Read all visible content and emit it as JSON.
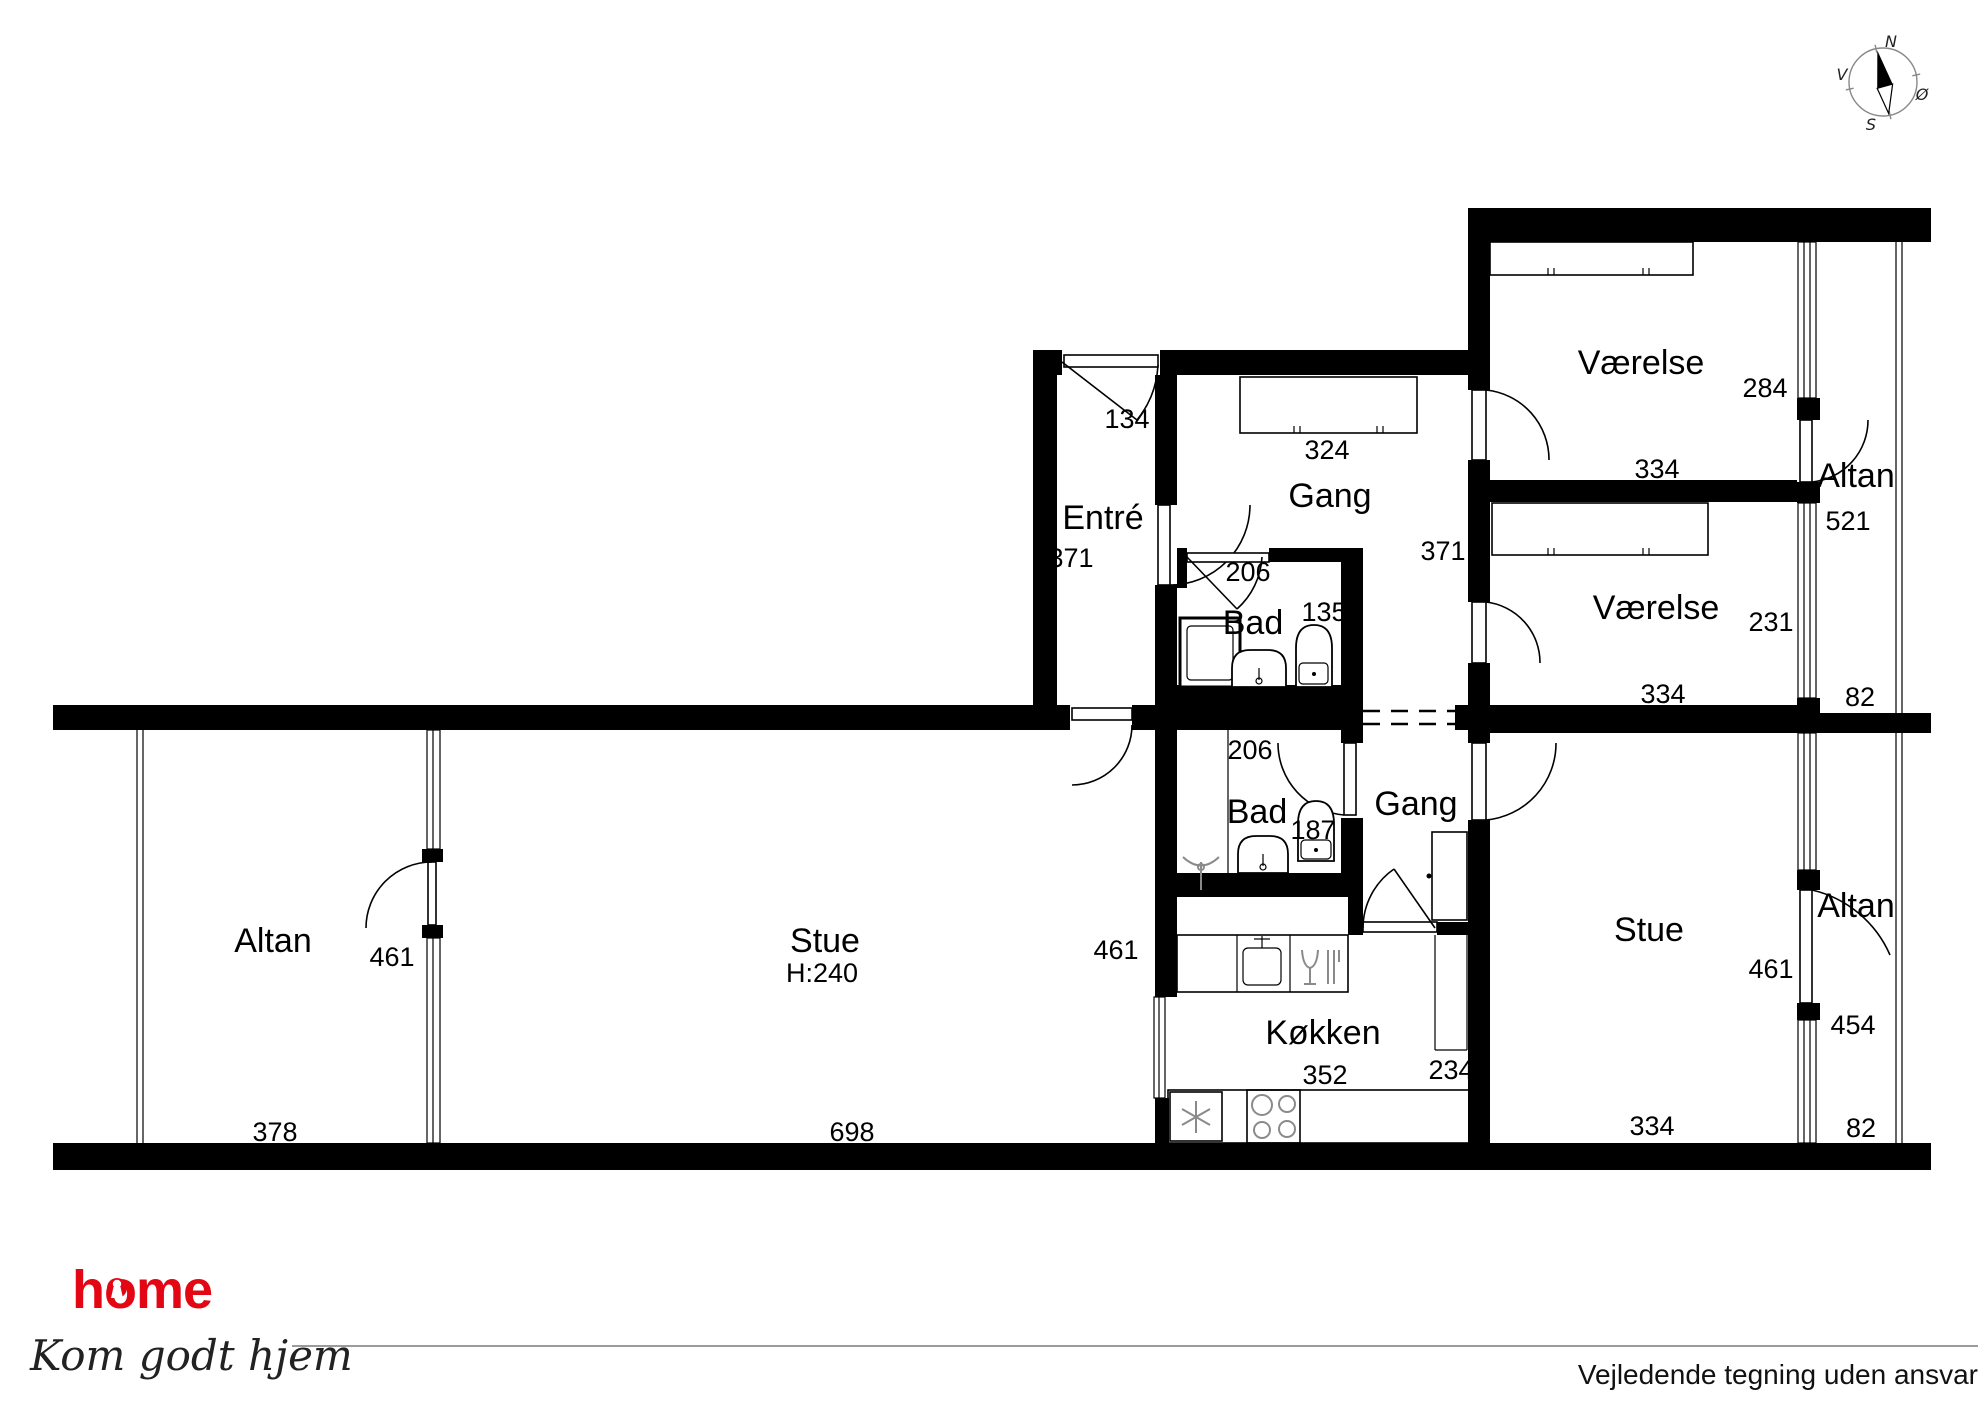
{
  "compass": {
    "north": "N",
    "south": "S",
    "west": "V",
    "east": "Ø"
  },
  "rooms": {
    "altan_left": {
      "label": "Altan"
    },
    "stue_left": {
      "label": "Stue",
      "ceiling_height": "H:240"
    },
    "entre": {
      "label": "Entré"
    },
    "gang_upper": {
      "label": "Gang"
    },
    "bad_upper": {
      "label": "Bad"
    },
    "bad_lower": {
      "label": "Bad"
    },
    "gang_lower": {
      "label": "Gang"
    },
    "kokken": {
      "label": "Køkken"
    },
    "vaerelse_top": {
      "label": "Værelse"
    },
    "vaerelse_mid": {
      "label": "Værelse"
    },
    "altan_top_right": {
      "label": "Altan"
    },
    "stue_right": {
      "label": "Stue"
    },
    "altan_bottom_right": {
      "label": "Altan"
    }
  },
  "dims": {
    "altan_left_w": "378",
    "altan_left_h": "461",
    "stue_left_w": "698",
    "stue_left_h": "461",
    "entre_door": "134",
    "entre_h": "371",
    "gang_upper_closet": "324",
    "gang_upper_h": "371",
    "bad_upper_door": "206",
    "bad_upper_w": "135",
    "bad_lower_door": "206",
    "bad_lower_w": "187",
    "kokken_w": "352",
    "kokken_shaft": "234",
    "vaerelse_top_h": "284",
    "vaerelse_top_w": "334",
    "vaerelse_mid_h": "231",
    "vaerelse_mid_w": "334",
    "altan_top_h": "521",
    "altan_top_w": "82",
    "stue_right_h": "461",
    "stue_right_w": "334",
    "altan_bottom_door": "454",
    "altan_bottom_w": "82"
  },
  "footer": {
    "brand": "home",
    "tagline": "Kom godt hjem",
    "disclaimer": "Vejledende tegning uden ansvar"
  },
  "colors": {
    "brand_red": "#e30613",
    "wall_black": "#000000",
    "divider_gray": "#9b9b9b"
  }
}
